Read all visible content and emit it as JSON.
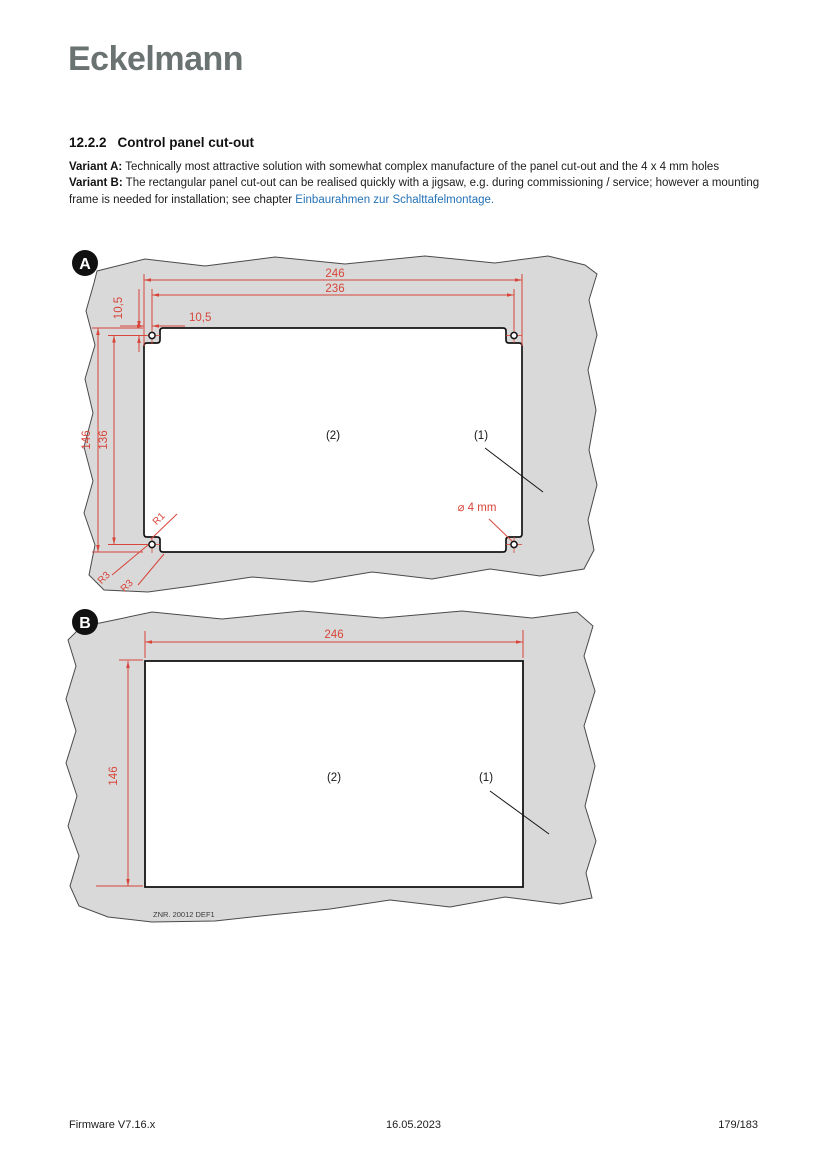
{
  "logo": "Eckelmann",
  "heading": {
    "number": "12.2.2",
    "title": "Control panel cut-out"
  },
  "intro": {
    "variant_a_label": "Variant A:",
    "variant_a_text": " Technically most attractive solution with somewhat complex manufacture of the panel cut-out and the 4 x 4 mm holes",
    "variant_b_label": "Variant B:",
    "variant_b_text": " The rectangular panel cut-out can be realised quickly with a jigsaw, e.g. during commissioning / service; however a mounting frame is needed for installation; see chapter ",
    "link_text": "Einbaurahmen zur Schalttafelmontage."
  },
  "diagram_a": {
    "badge": "A",
    "dims": {
      "width_outer": "246",
      "width_hole_centers": "236",
      "hole_offset_horizontal": "10,5",
      "hole_offset_vertical": "10,5",
      "height_outer": "146",
      "height_hole_centers": "136",
      "radius_step": "R1",
      "radius_corner_1": "R3",
      "radius_corner_2": "R3",
      "hole_diameter": "⌀ 4 mm"
    },
    "labels": {
      "cutout": "(2)",
      "panel": "(1)"
    }
  },
  "diagram_b": {
    "badge": "B",
    "dims": {
      "width": "246",
      "height": "146"
    },
    "labels": {
      "cutout": "(2)",
      "panel": "(1)"
    },
    "drawing_number": "ZNR. 20012 DEF1"
  },
  "footer": {
    "left": "Firmware V7.16.x",
    "center": "16.05.2023",
    "right": "179/183"
  },
  "colors": {
    "dimension_red": "#d8453a",
    "panel_gray": "#d9d9d9",
    "link_blue": "#2472b8",
    "logo_gray": "#6b7272"
  }
}
